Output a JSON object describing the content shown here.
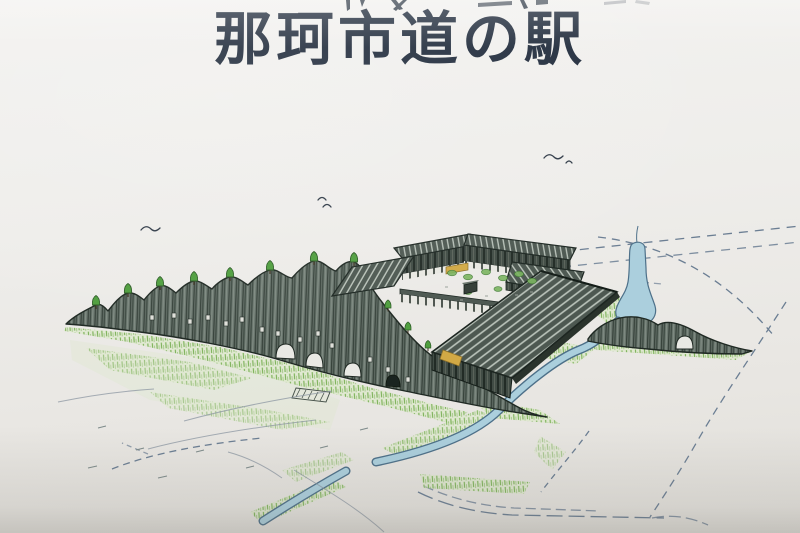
{
  "page": {
    "title": "那珂市道の駅"
  },
  "illustration": {
    "name": "naka-city-roadside-station-aerial-sketch",
    "features": [
      "undulating-earth-mound-wall-with-trees",
      "courtyard-building-complex",
      "striped-gable-roofs",
      "irrigation-canal",
      "pond",
      "farm-field-dashed-lines",
      "meadow-grass",
      "flying-birds"
    ]
  },
  "colors": {
    "paper_top": "#f3f2f0",
    "paper_bottom": "#e2e0db",
    "title_ink": "#222d3d",
    "ink": "#2e3a34",
    "mound_fill": "#68746c",
    "roof_fill": "#4d5851",
    "roof_stripe": "#bcc5bc",
    "wall_fill": "#414c45",
    "grass": "#7fb35c",
    "grass_wash": "#d9e8c3",
    "tree": "#4f9e3e",
    "tree_outline": "#2d5c26",
    "water": "#abcfdd",
    "water_outline": "#4d7089",
    "field_line": "#6b7e93",
    "accent_tan": "#d2a945"
  }
}
